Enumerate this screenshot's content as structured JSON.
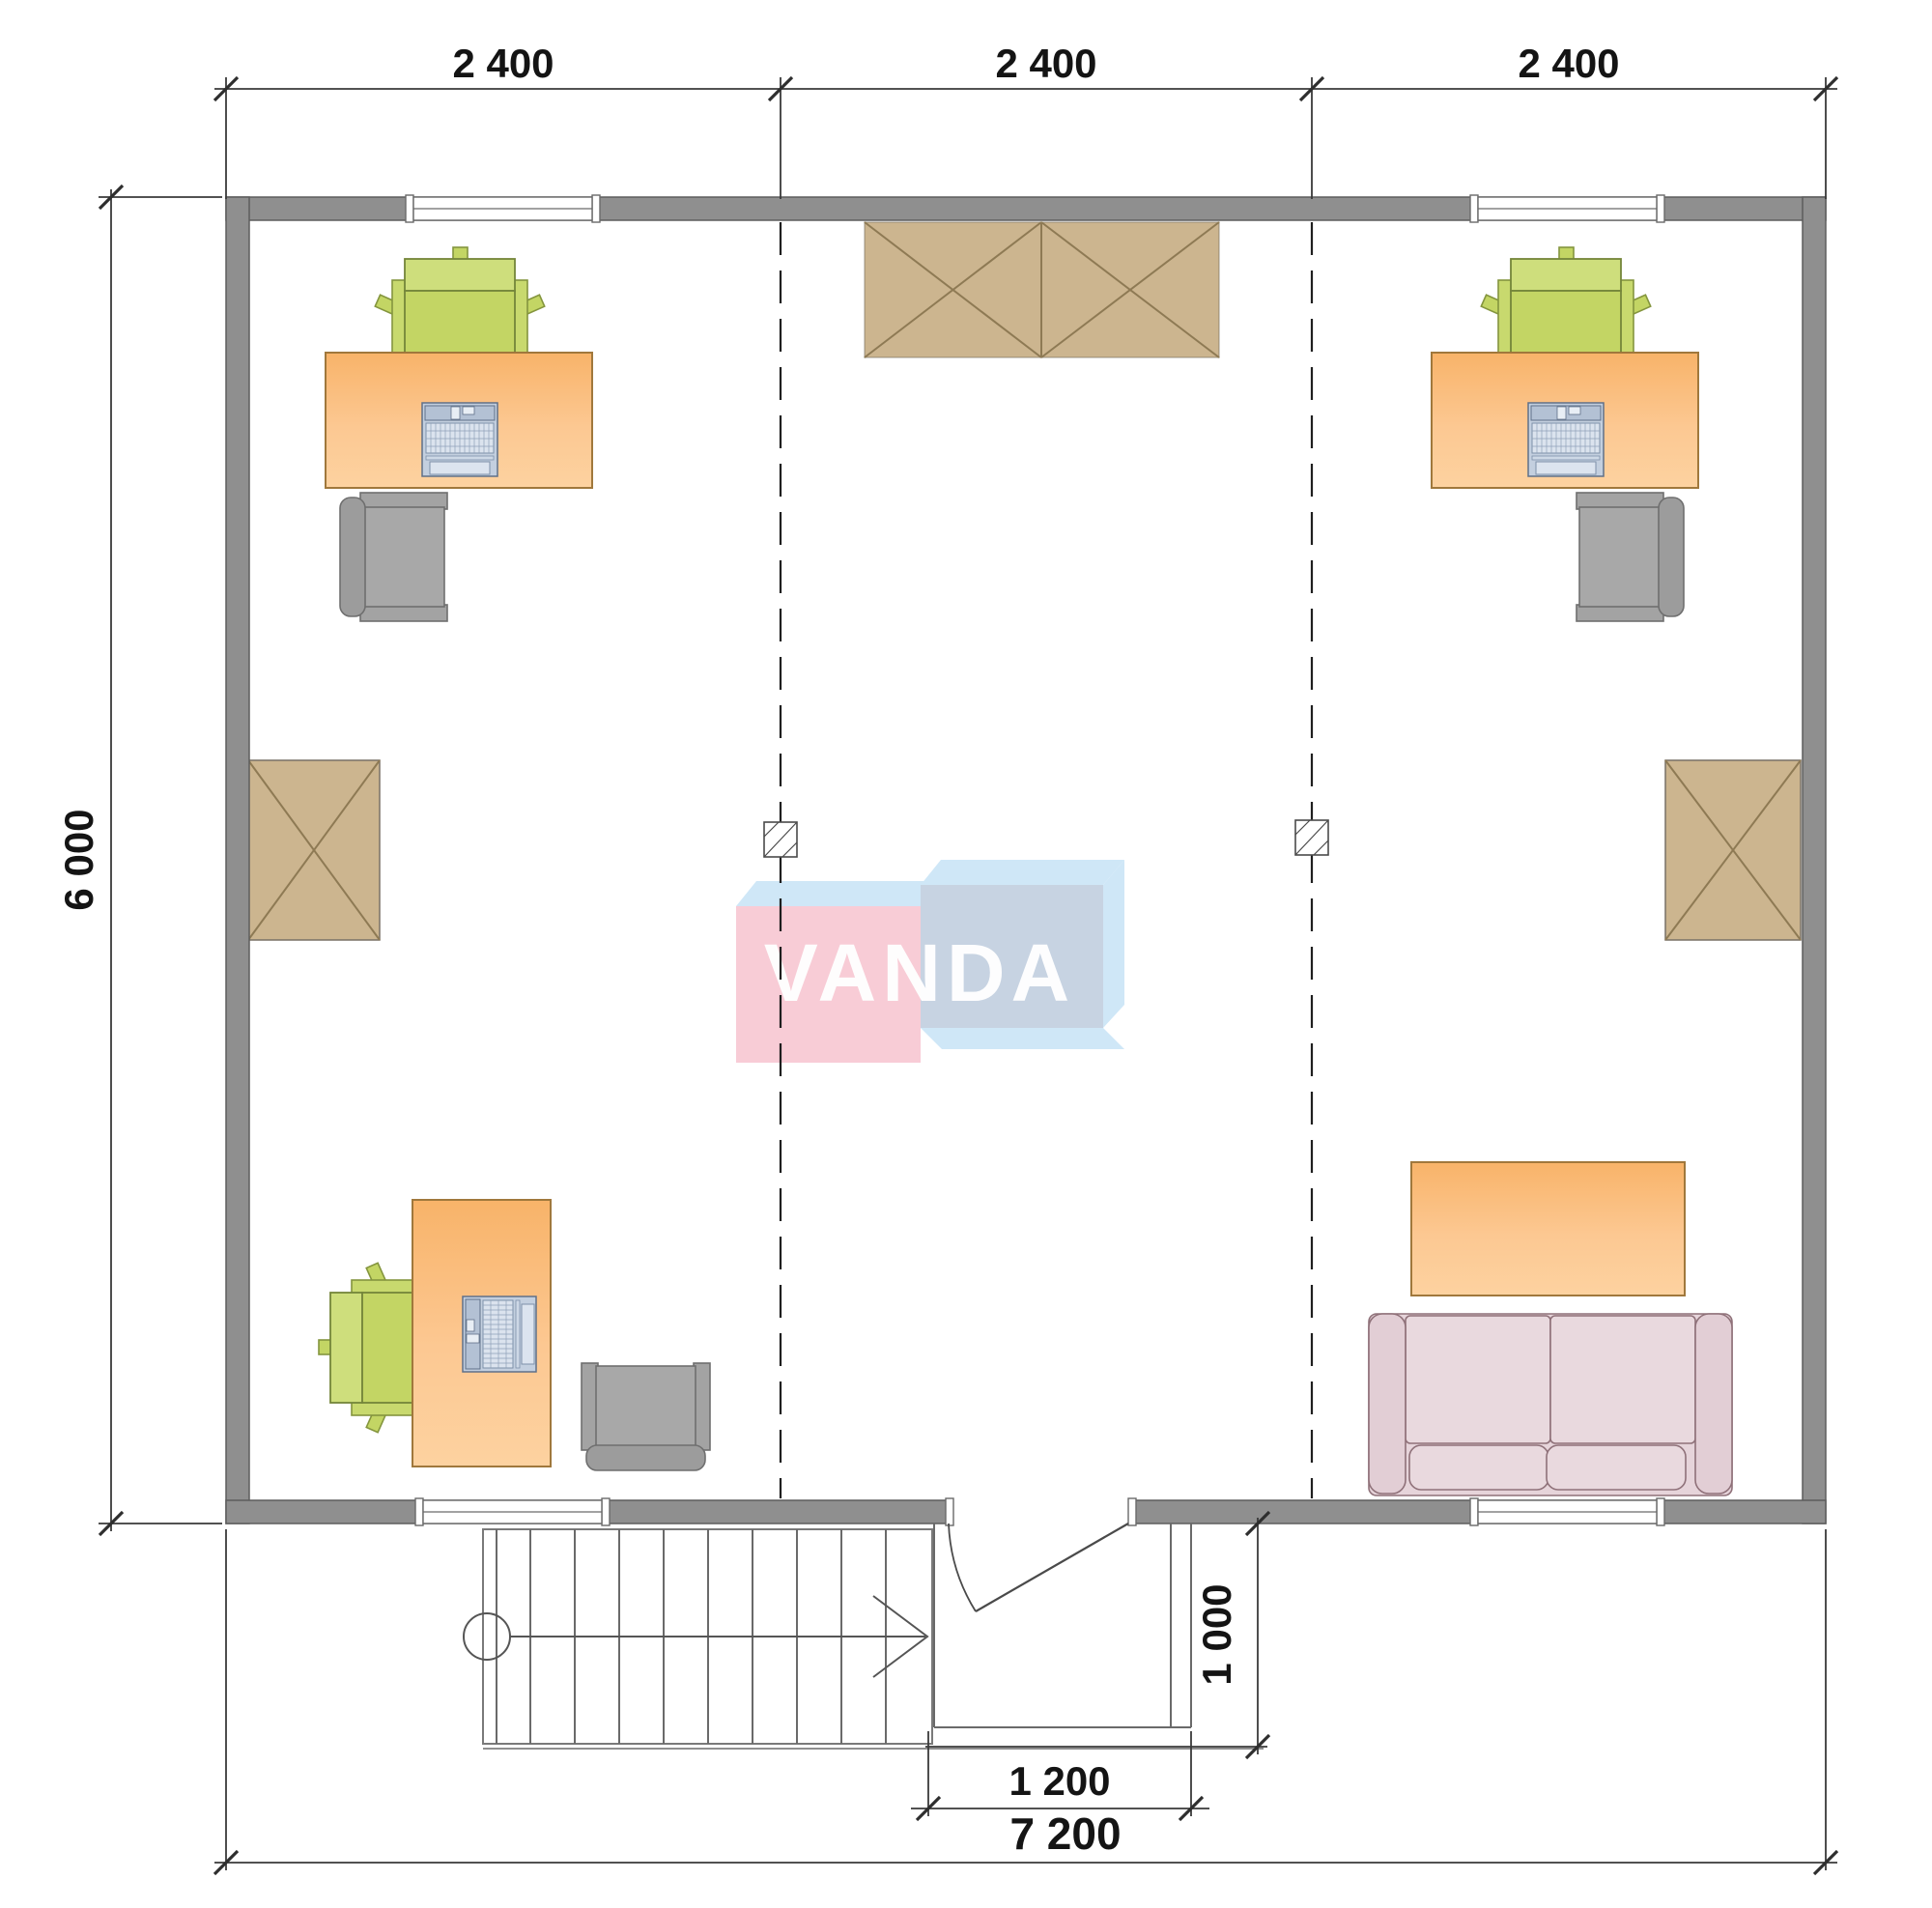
{
  "watermark": {
    "brand": "VANDA"
  },
  "dimensions": {
    "top_bays": [
      "2 400",
      "2 400",
      "2 400"
    ],
    "side_height": "6 000",
    "entry_depth": "1 000",
    "entry_width": "1 200",
    "total_width": "7 200"
  },
  "colors": {
    "wall": "#8f8f8f",
    "desk_orange": "#fbc084",
    "chair_green": "#c8d96e",
    "chair_gray": "#a3a3a3",
    "wardrobe_tan": "#ccb58f",
    "sofa_pink": "#e6d4da",
    "laptop_blue": "#c3cfdf",
    "watermark_pink": "#f8ccd6",
    "watermark_blue_front": "#c7d3e2",
    "watermark_light_blue": "#cfe7f7",
    "dimension_text": "#141414"
  }
}
